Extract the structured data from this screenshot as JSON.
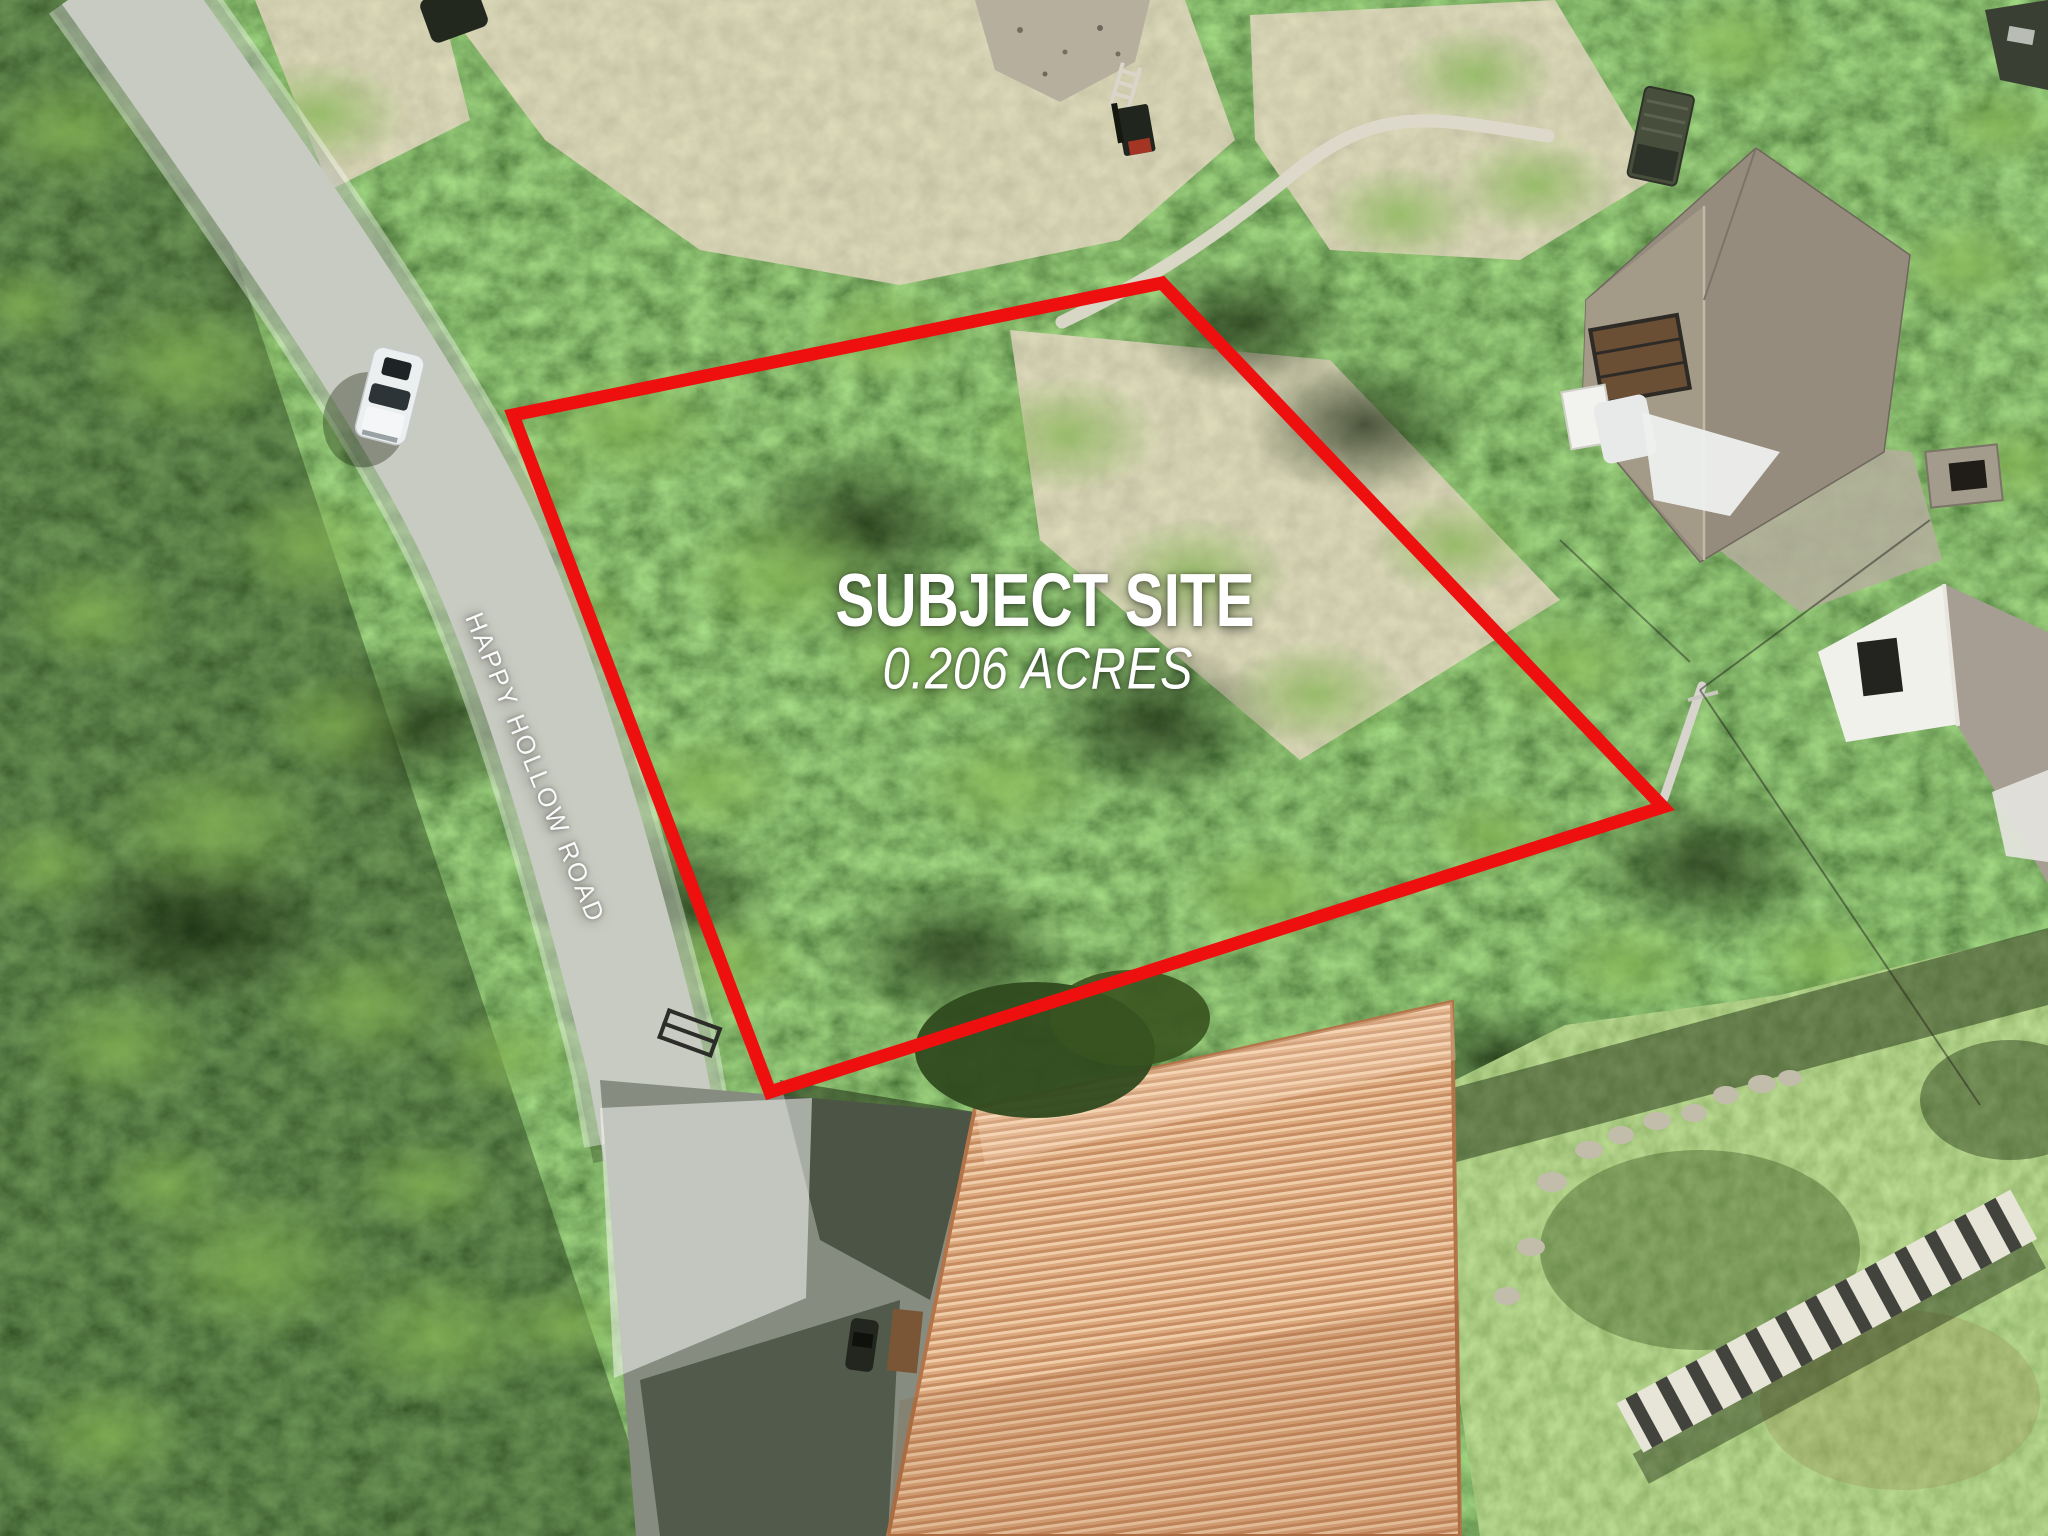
{
  "annotations": {
    "site_title": "SUBJECT SITE",
    "site_acreage": "0.206 ACRES",
    "road_name": "HAPPY HOLLOW ROAD",
    "boundary_color": "#ee0f0f",
    "label_color": "#ffffff",
    "road_highlight_color": "rgba(255,255,255,0.38)"
  },
  "scene": {
    "type": "aerial-drone-photo",
    "description": "Aerial view of a wooded 0.206-acre lot outlined in red beside Happy Hollow Road",
    "ground_colors": {
      "forest_dark": "#2c4519",
      "forest_light": "#6fa045",
      "dirt_tan": "#cbbd9c",
      "road_gray": "#a7aa9d",
      "driveway_gray": "#878c80",
      "lawn_green": "#6f9140",
      "stone_light": "#e7e5d8"
    },
    "objects": {
      "vehicle_on_road": "white truck driving on road",
      "metal_roof_building": "orange ribbed metal roof",
      "metal_roof_color": "#dca87e",
      "house": "two-story house with gray shingle roof",
      "house_roof_color": "#968c7e",
      "shade_sail": "white shade sail",
      "white_outbuilding": "white gabled outbuilding",
      "stone_wall": "curved white stone retaining wall",
      "gravel_pile": "gravel pile with ladder and forklift",
      "parked_truck": "olive military-style truck",
      "stone_staircase": "stone staircase on lawn",
      "stepping_stones": "stepping stone path",
      "utility_pole": "utility pole with wires"
    }
  }
}
